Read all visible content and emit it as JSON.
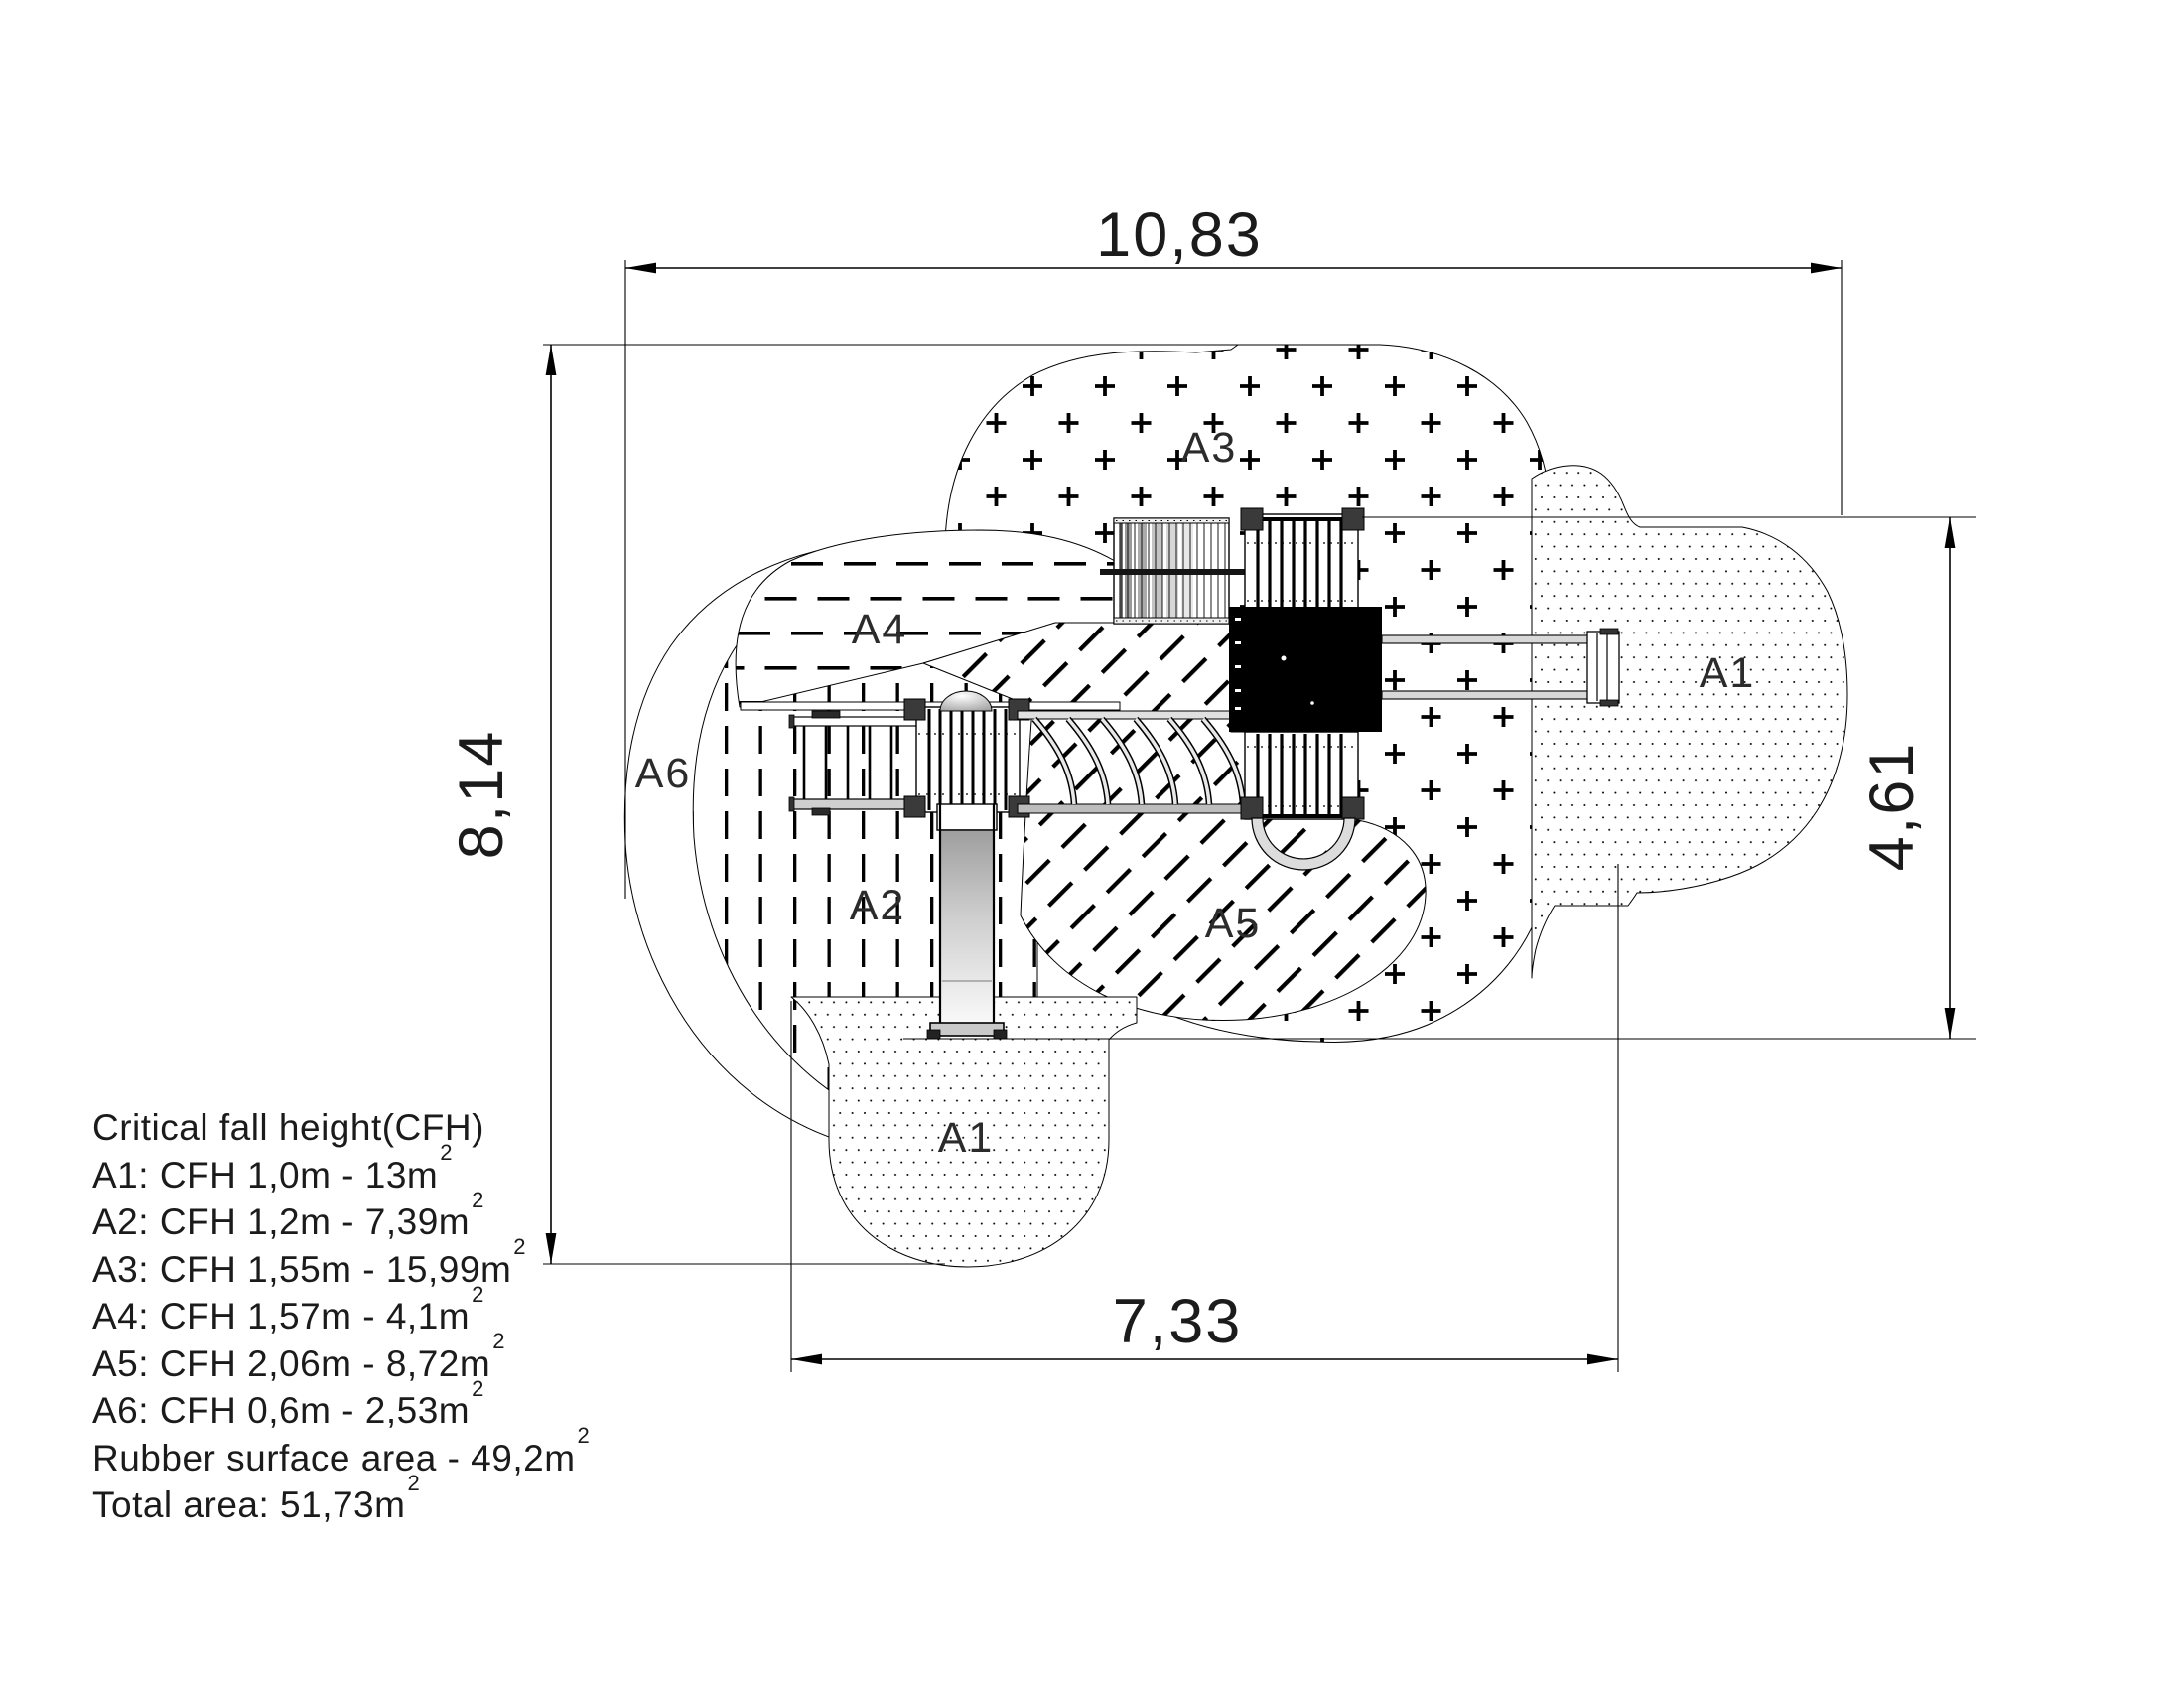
{
  "areas": {
    "a3": "A3",
    "a4": "A4",
    "a6": "A6",
    "a2": "A2",
    "a5": "A5",
    "a1_right": "A1",
    "a1_bottom": "A1"
  },
  "dimensions": {
    "width_total": "10,83",
    "height_total": "8,14",
    "height_right": "4,61",
    "width_bottom": "7,33"
  },
  "legend": {
    "title": "Critical fall height(CFH)",
    "items": [
      {
        "text": "A1: CFH 1,0m - 13m",
        "sup": "2"
      },
      {
        "text": "A2: CFH 1,2m - 7,39m",
        "sup": "2"
      },
      {
        "text": "A3: CFH 1,55m - 15,99m",
        "sup": "2"
      },
      {
        "text": "A4: CFH 1,57m - 4,1m",
        "sup": "2"
      },
      {
        "text": "A5: CFH 2,06m - 8,72m",
        "sup": "2"
      },
      {
        "text": "A6: CFH 0,6m - 2,53m",
        "sup": "2"
      },
      {
        "text": "Rubber surface area - 49,2m",
        "sup": "2"
      },
      {
        "text": "Total area: 51,73m",
        "sup": "2"
      }
    ]
  },
  "colors": {
    "ink": "#000000",
    "paper": "#ffffff",
    "label_ink": "#2b2b2b",
    "equipment_roof": "#000000",
    "slide_gray": "#b8b8b8"
  }
}
